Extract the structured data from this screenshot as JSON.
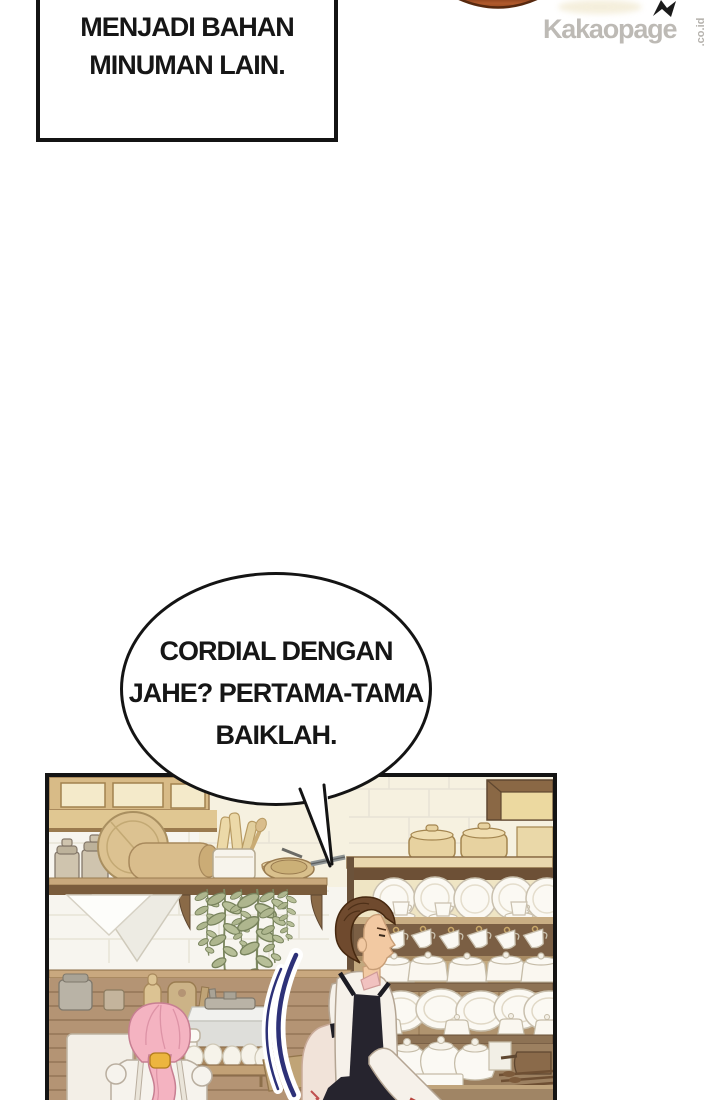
{
  "watermark": {
    "brand": "Kakaopage",
    "suffix": ".co.id"
  },
  "caption_box": {
    "lines": [
      "BIASANYA AKAN",
      "MENJADI BAHAN",
      "MINUMAN LAIN."
    ]
  },
  "speech_bubble": {
    "lines": [
      "CORDIAL DENGAN",
      "JAHE? PERTAMA-TAMA",
      "BAIKLAH."
    ]
  },
  "palette": {
    "outline_black": "#141414",
    "watermark_gray": "#bdbab5",
    "orange_fragment": "#a8512a",
    "wood_brown": "#b49474",
    "wood_dark": "#7b6248",
    "shelf_tan": "#d9bf8f",
    "dish_white": "#fbf9f3",
    "plant_green": "#aeb68e",
    "girl_hair_pink": "#f4b3c1",
    "chef_hair_brown": "#6f4a2e",
    "apron_black": "#26242e",
    "effect_blue": "#2d3178",
    "skin": "#f2c9a2"
  }
}
